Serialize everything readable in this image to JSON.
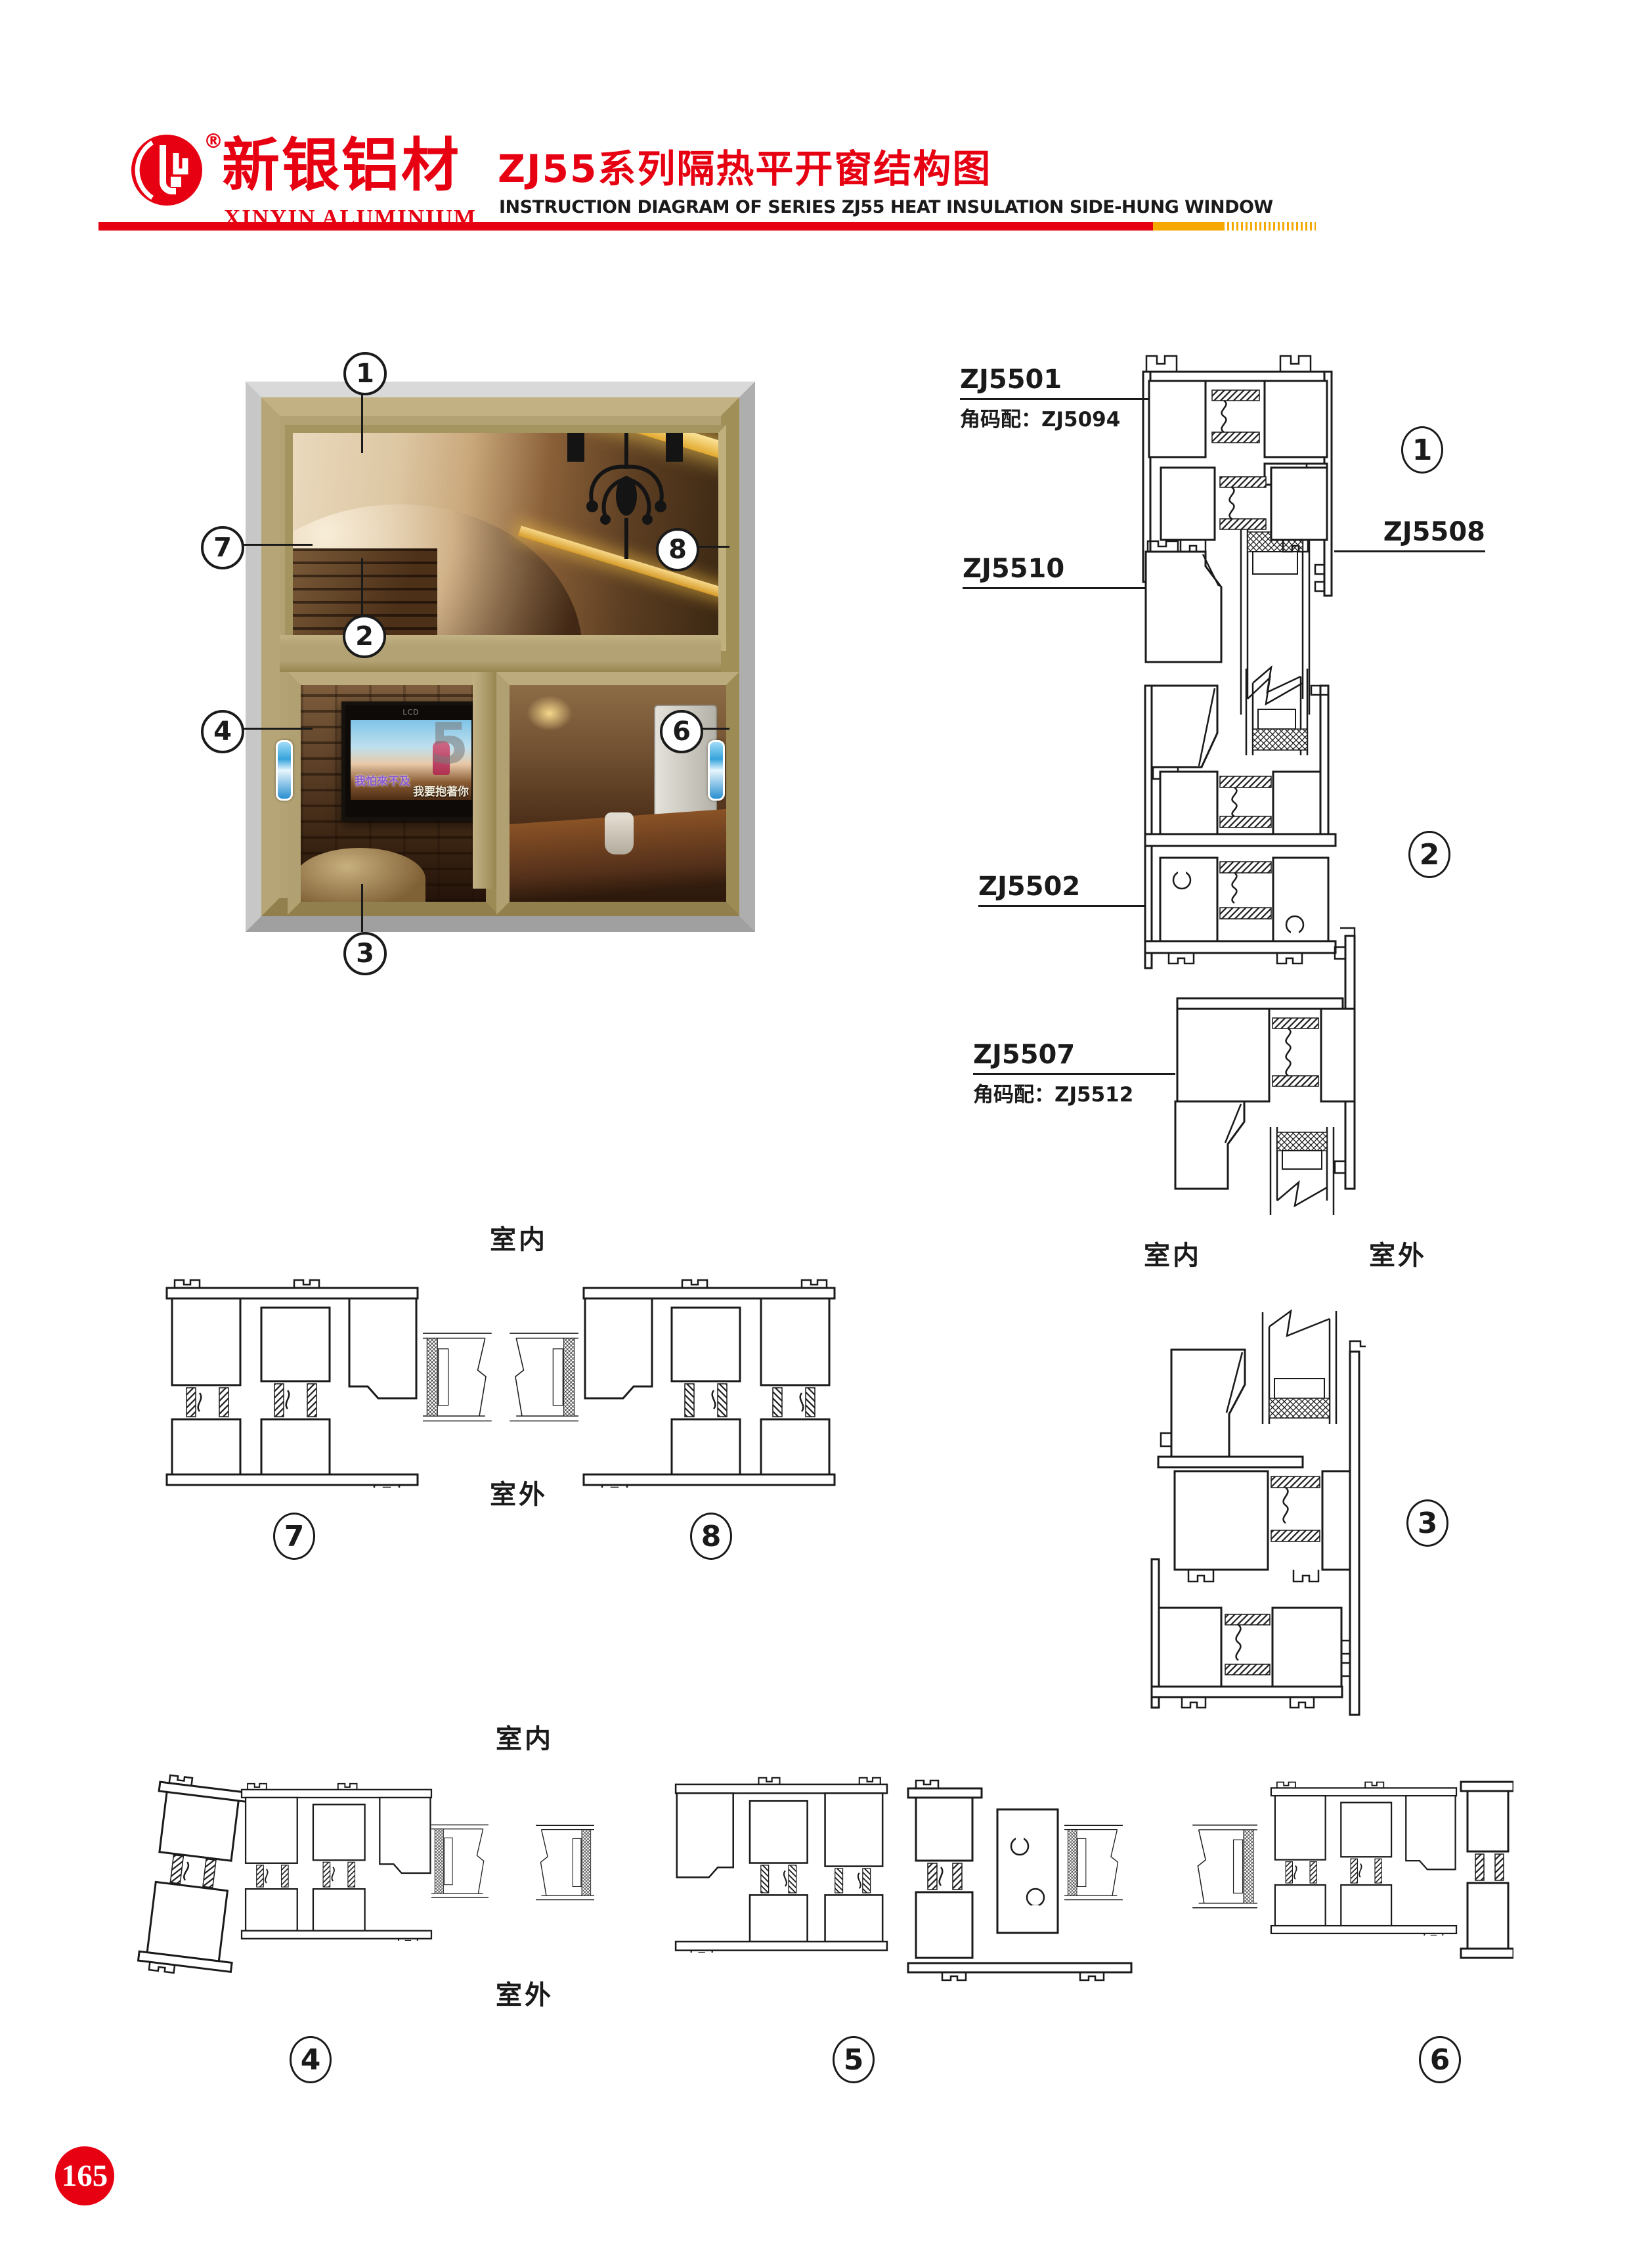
{
  "page": {
    "number": "165"
  },
  "header": {
    "logo_cn": "新银铝材",
    "logo_en": "XINYIN ALUMINIUM",
    "registered": "®",
    "title_cn": "ZJ55系列隔热平开窗结构图",
    "title_en": "INSTRUCTION DIAGRAM OF SERIES ZJ55 HEAT INSULATION SIDE-HUNG WINDOW"
  },
  "colors": {
    "brand_red": "#e60012",
    "accent_yellow": "#f5a800",
    "frame_tan": "#b3a274",
    "outer_gray": "#c9c9c9",
    "handle_blue": "#37a3dc",
    "line_black": "#1a1a1a"
  },
  "window": {
    "callout_1": "1",
    "callout_2": "2",
    "callout_3": "3",
    "callout_4": "4",
    "callout_5": "5",
    "callout_6": "6",
    "callout_7": "7",
    "callout_8": "8",
    "tv_brand": "LCD",
    "tv_caption_1": "我怕來不及",
    "tv_caption_2": "我要抱著你"
  },
  "sections": {
    "s1": {
      "label_top": "ZJ5501",
      "label_top_sub": "角码配：ZJ5094",
      "label_bottom": "ZJ5510",
      "label_right": "ZJ5508",
      "num": "1"
    },
    "s2": {
      "label_top": "ZJ5502",
      "label_bottom": "ZJ5507",
      "label_bottom_sub": "角码配：ZJ5512",
      "num": "2"
    },
    "s3": {
      "num": "3"
    },
    "right_col": {
      "indoor": "室内",
      "outdoor": "室外"
    },
    "mid_row": {
      "indoor": "室内",
      "outdoor": "室外",
      "num_left": "7",
      "num_right": "8"
    },
    "bottom_row": {
      "indoor": "室内",
      "outdoor": "室外",
      "num_a": "4",
      "num_b": "5",
      "num_c": "6"
    }
  }
}
